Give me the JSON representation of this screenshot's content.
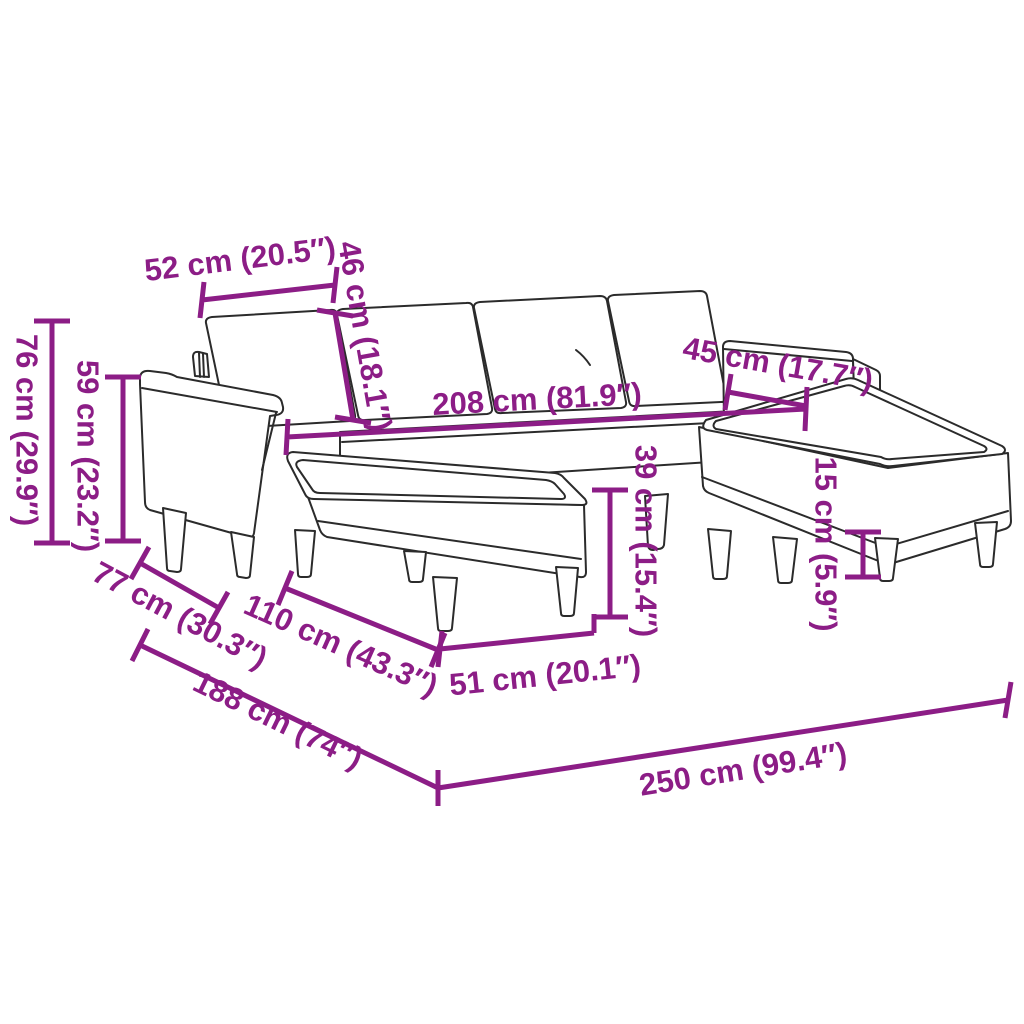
{
  "diagram": {
    "subject": "u-shaped-sofa-with-footstools-dimension-diagram",
    "background_color": "#ffffff",
    "dimension_color": "#8C1D86",
    "outline_color": "#2b2b2b",
    "measurements": [
      {
        "id": "seat-depth",
        "label": "52 cm (20.5″)"
      },
      {
        "id": "backrest-height",
        "label": "46 cm (18.1″)"
      },
      {
        "id": "total-height",
        "label": "76 cm (29.9″)"
      },
      {
        "id": "armrest-height",
        "label": "59 cm (23.2″)"
      },
      {
        "id": "right-armrest-width",
        "label": "45 cm (17.7″)"
      },
      {
        "id": "inner-width",
        "label": "208 cm (81.9″)"
      },
      {
        "id": "seat-height",
        "label": "39 cm (15.4″)"
      },
      {
        "id": "armrest-depth",
        "label": "77 cm (30.3″)"
      },
      {
        "id": "footstool-length",
        "label": "110 cm (43.3″)"
      },
      {
        "id": "footstool-width",
        "label": "51 cm (20.1″)"
      },
      {
        "id": "leg-height",
        "label": "15 cm (5.9″)"
      },
      {
        "id": "total-depth",
        "label": "188 cm (74″)"
      },
      {
        "id": "total-width",
        "label": "250 cm (99.4″)"
      }
    ]
  }
}
